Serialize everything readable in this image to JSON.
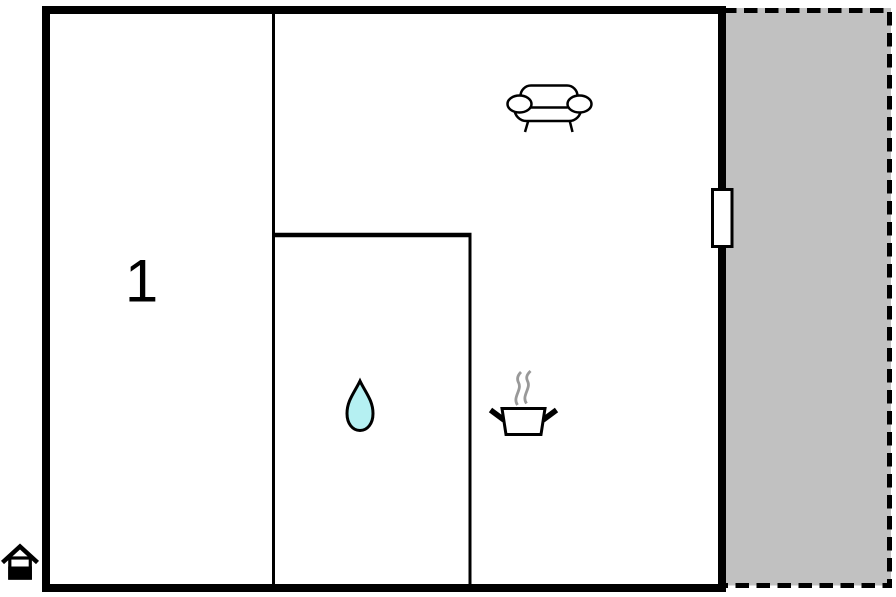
{
  "floor_plan": {
    "rooms": [
      {
        "id": "room-1",
        "label": "1"
      }
    ],
    "icons": [
      "sofa-icon",
      "water-drop-icon",
      "cooking-pot-icon",
      "steam-icon",
      "window-icon",
      "house-entrance-icon"
    ],
    "colors": {
      "wall": "#000000",
      "floor": "#ffffff",
      "terrace_fill": "#c1c1c1",
      "water_drop_fill": "#b5f0f2",
      "steam": "#999999"
    }
  }
}
